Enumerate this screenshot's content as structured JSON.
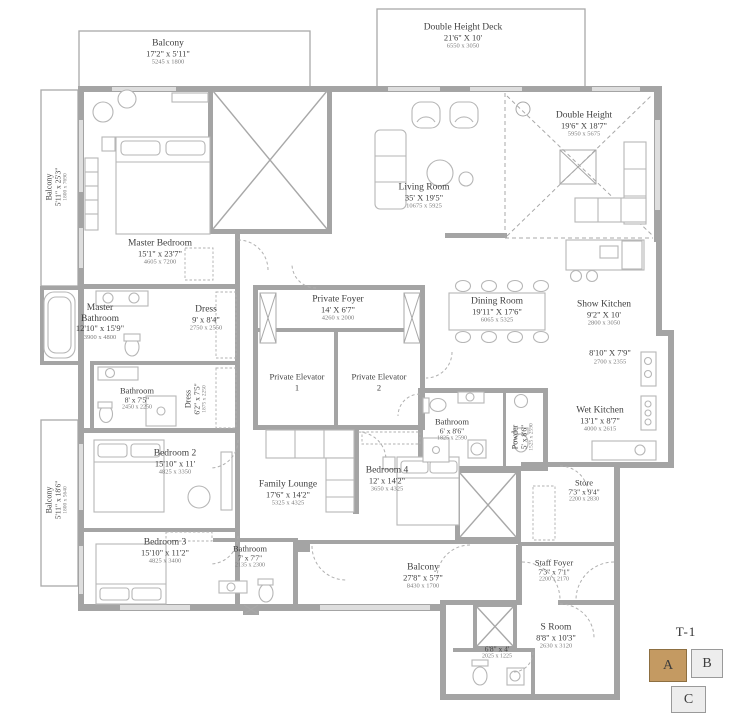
{
  "plan": {
    "rooms": {
      "balcony_top": {
        "name": "Balcony",
        "dims": "17'2\" x 5'11\"",
        "metric": "5245 x 1800"
      },
      "balcony_left_upper": {
        "name": "Balcony",
        "dims": "5'11\" x 25'3\"",
        "metric": "1800 x 7690"
      },
      "balcony_left_lower": {
        "name": "Balcony",
        "dims": "5'11\" x 18'6\"",
        "metric": "1800 x 5640"
      },
      "double_height_deck": {
        "name": "Double Height Deck",
        "dims": "21'6\" X 10'",
        "metric": "6550 x 3050"
      },
      "double_height": {
        "name": "Double Height",
        "dims": "19'6\" X 18'7\"",
        "metric": "5950 x 5675"
      },
      "living_room": {
        "name": "Living Room",
        "dims": "35' X 19'5\"",
        "metric": "10675 x 5925"
      },
      "master_bedroom": {
        "name": "Master Bedroom",
        "dims": "15'1\" x 23'7\"",
        "metric": "4605 x 7200"
      },
      "master_bathroom": {
        "name": "Master Bathroom",
        "dims": "12'10\" x 15'9\"",
        "metric": "3900 x 4800"
      },
      "dress": {
        "name": "Dress",
        "dims": "9' x 8'4\"",
        "metric": "2750 x 2550"
      },
      "bathroom_2": {
        "name": "Bathroom",
        "dims": "8' x 7'5\"",
        "metric": "2450 x 2250"
      },
      "dress_2": {
        "name": "Dress",
        "dims": "6'2\" x 7'5\"",
        "metric": "1875 x 2250"
      },
      "private_foyer": {
        "name": "Private Foyer",
        "dims": "14' X 6'7\"",
        "metric": "4260 x 2000"
      },
      "private_elevator_1": {
        "name": "Private Elevator 1"
      },
      "private_elevator_2": {
        "name": "Private Elevator 2"
      },
      "dining_room": {
        "name": "Dining Room",
        "dims": "19'11\" X 17'6\"",
        "metric": "6065 x 5325"
      },
      "show_kitchen": {
        "name": "Show Kitchen",
        "dims": "9'2\" X 10'",
        "metric": "2800 x 3050"
      },
      "kitchen_pantry": {
        "dims": "8'10\" X 7'9\"",
        "metric": "2700 x 2355"
      },
      "wet_kitchen": {
        "name": "Wet Kitchen",
        "dims": "13'1\" x 8'7\"",
        "metric": "4000 x 2615"
      },
      "bathroom_3": {
        "name": "Bathroom",
        "dims": "6' x 8'6\"",
        "metric": "1825 x 2590"
      },
      "powder": {
        "name": "Powder",
        "dims": "5' x 8'6\"",
        "metric": "1525 x 2590"
      },
      "bedroom_2": {
        "name": "Bedroom 2",
        "dims": "15'10\" x 11'",
        "metric": "4825 x 3350"
      },
      "bedroom_3": {
        "name": "Bedroom 3",
        "dims": "15'10\" x 11'2\"",
        "metric": "4825 x 3400"
      },
      "family_lounge": {
        "name": "Family Lounge",
        "dims": "17'6\" x 14'2\"",
        "metric": "5325 x 4325"
      },
      "bedroom_4": {
        "name": "Bedroom 4",
        "dims": "12' x 14'2\"",
        "metric": "3650 x 4325"
      },
      "bathroom_4": {
        "name": "Bathroom",
        "dims": "7' x 7'7\"",
        "metric": "2135 x 2300"
      },
      "balcony_bottom": {
        "name": "Balcony",
        "dims": "27'8\" x 5'7\"",
        "metric": "8430 x 1700"
      },
      "store": {
        "name": "Store",
        "dims": "7'3\" x 9'4\"",
        "metric": "2200 x 2830"
      },
      "staff_foyer": {
        "name": "Staff Foyer",
        "dims": "7'3\" x 7'1\"",
        "metric": "2200 x 2170"
      },
      "s_room": {
        "name": "S Room",
        "dims": "8'8\" x 10'3\"",
        "metric": "2630 x 3120"
      },
      "s_bathroom": {
        "dims": "6'8\" x 4'",
        "metric": "2025 x 1225"
      }
    },
    "keyplan": {
      "label": "T-1",
      "units": [
        {
          "label": "A",
          "highlighted": true
        },
        {
          "label": "B",
          "highlighted": false
        },
        {
          "label": "C",
          "highlighted": false
        }
      ]
    },
    "colors": {
      "wall": "#a4a4a4",
      "furniture_line": "#b6b6b6",
      "text": "#3f3f3f",
      "metric_text": "#7d7d7d",
      "keyplan_highlight": "#c49a62"
    }
  }
}
